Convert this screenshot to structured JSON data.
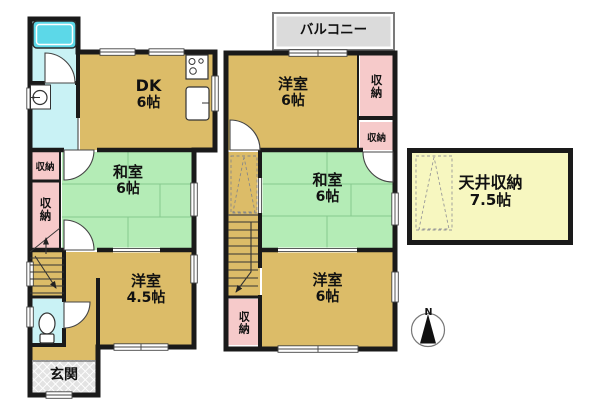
{
  "floor1": {
    "dk": {
      "label": "DK",
      "size": "6帖"
    },
    "washitsu": {
      "label": "和室",
      "size": "6帖"
    },
    "youshitsu": {
      "label": "洋室",
      "size": "4.5帖"
    },
    "storage_upper": {
      "label": "収納"
    },
    "storage_lower": {
      "label": "収納"
    },
    "genkan": {
      "label": "玄関"
    }
  },
  "floor2": {
    "balcony": {
      "label": "バルコニー"
    },
    "youshitsu_north": {
      "label": "洋室",
      "size": "6帖"
    },
    "storage_ne_tall": {
      "label": "収納"
    },
    "storage_ne_small": {
      "label": "収納"
    },
    "washitsu": {
      "label": "和室",
      "size": "6帖"
    },
    "youshitsu_south": {
      "label": "洋室",
      "size": "6帖"
    },
    "storage_sw": {
      "label": "収納"
    }
  },
  "attic": {
    "label": "天井収納",
    "size": "7.5帖"
  },
  "compass": {
    "label": "N"
  },
  "colors": {
    "wall": "#1a1a1a",
    "room_tan": "#dcbc68",
    "tatami_green": "#b4ecb6",
    "storage_pink": "#f6caca",
    "wet_cyan": "#c9f2f5",
    "bathtub": "#5cd8e8",
    "balcony_gray": "#dbdbdb",
    "genkan_gray": "#e3e3e3",
    "attic_yellow": "#f7f7c0"
  }
}
